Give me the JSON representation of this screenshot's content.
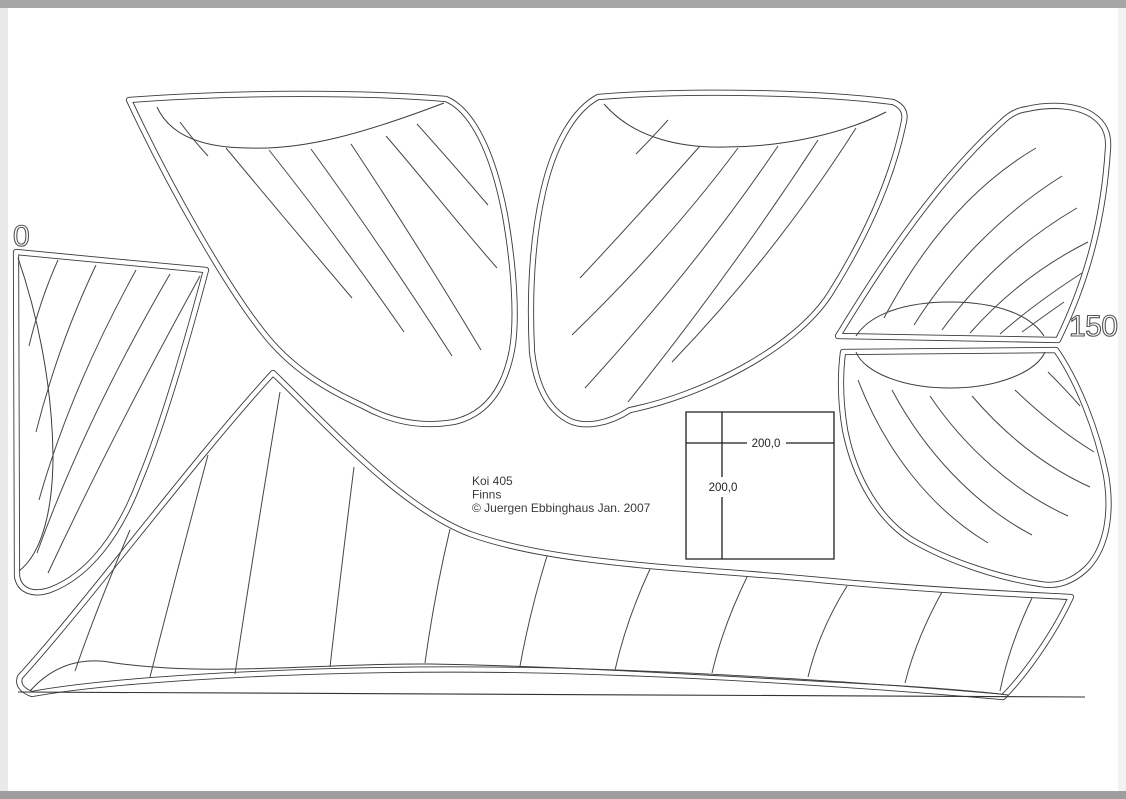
{
  "page": {
    "background": "#ffffff",
    "line_color": "#3a3a3a",
    "border_top_color": "#a6a6a6",
    "border_bottom_color": "#9e9e9e",
    "border_left_color": "#e9e9e9",
    "border_right_color": "#f2f2f2"
  },
  "title_block": {
    "line1": "Koi 405",
    "line2": "Finns",
    "line3": "© Juergen Ebbinghaus Jan. 2007"
  },
  "ruler_labels": {
    "left": "0",
    "right": "150"
  },
  "scale_box": {
    "width_label": "200,0",
    "height_label": "200,0"
  }
}
